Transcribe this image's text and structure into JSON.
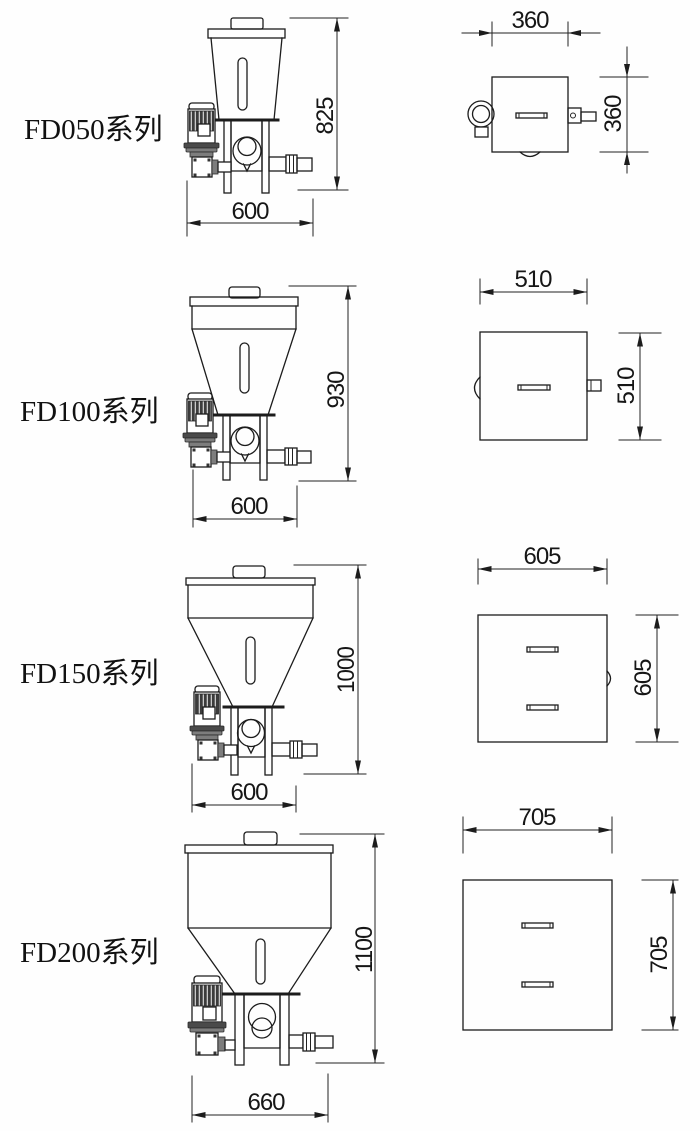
{
  "colors": {
    "line": "#1c1c1c",
    "background": "#ffffff"
  },
  "rows": [
    {
      "series_label": "FD050系列",
      "front_view": {
        "height_dim": "825",
        "width_dim": "600"
      },
      "top_view": {
        "width_dim": "360",
        "height_dim": "360"
      }
    },
    {
      "series_label": "FD100系列",
      "front_view": {
        "height_dim": "930",
        "width_dim": "600"
      },
      "top_view": {
        "width_dim": "510",
        "height_dim": "510"
      }
    },
    {
      "series_label": "FD150系列",
      "front_view": {
        "height_dim": "1000",
        "width_dim": "600"
      },
      "top_view": {
        "width_dim": "605",
        "height_dim": "605"
      }
    },
    {
      "series_label": "FD200系列",
      "front_view": {
        "height_dim": "1100",
        "width_dim": "660"
      },
      "top_view": {
        "width_dim": "705",
        "height_dim": "705"
      }
    }
  ]
}
